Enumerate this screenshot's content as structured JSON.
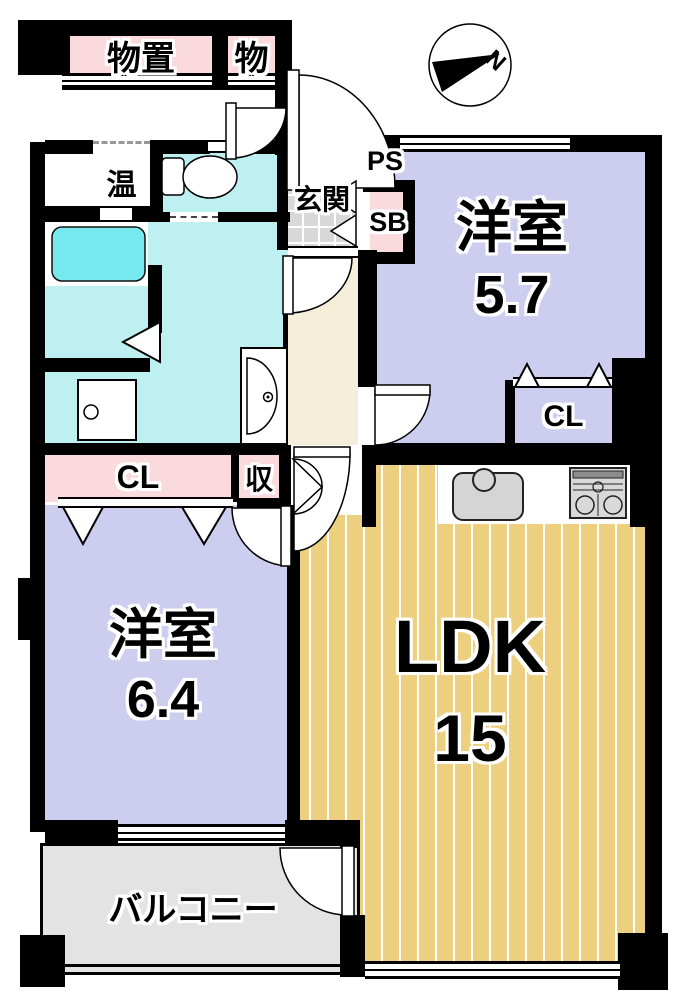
{
  "floorplan": {
    "title": "apartment-floor-plan",
    "compass": {
      "north_label": "N"
    },
    "rooms": {
      "storage_large": {
        "label": "物置"
      },
      "storage_small": {
        "label": "物"
      },
      "water_heater": {
        "label": "温"
      },
      "entrance": {
        "label": "玄関"
      },
      "pipe_space": {
        "label": "PS"
      },
      "shoe_box": {
        "label": "SB"
      },
      "western_room_1": {
        "label": "洋室",
        "size": "5.7"
      },
      "closet_right": {
        "label": "CL"
      },
      "closet_left": {
        "label": "CL"
      },
      "storage_closet": {
        "label": "収"
      },
      "western_room_2": {
        "label": "洋室",
        "size": "6.4"
      },
      "ldk": {
        "label": "LDK",
        "size": "15"
      },
      "balcony": {
        "label": "バルコニー"
      }
    },
    "colors": {
      "wall": "#000000",
      "storage_closet_pink": "#fadadd",
      "western_room_lavender": "#cdcdef",
      "wet_area_cyan": "#bff0f1",
      "bathtub_cyan": "#76e9ee",
      "ldk_wood": "#eccf7f",
      "entrance_tile": "#d8d8d8",
      "corridor_cream": "#f5eedb",
      "balcony_gray": "#e3e3e3"
    }
  }
}
